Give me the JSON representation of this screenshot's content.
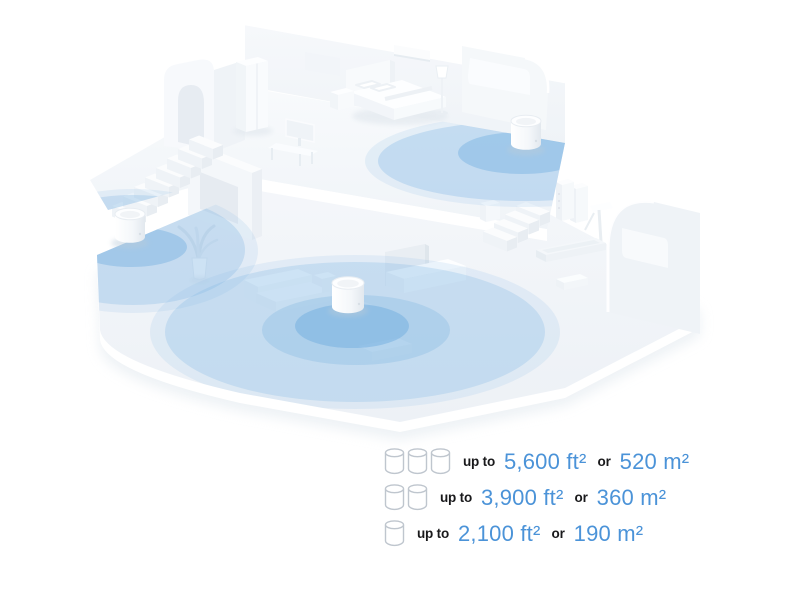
{
  "page": {
    "background": "#ffffff"
  },
  "illustration": {
    "type": "isometric-house-wifi-coverage",
    "device_icon": "mesh-wifi-unit-cylinder",
    "device_count": 3,
    "coverage_color": "#6eafe2",
    "house_color": "#f3f6f9"
  },
  "coverage": {
    "value_color": "#4b93d8",
    "label_color": "#19191b",
    "rows": [
      {
        "units": 3,
        "upto_label": "up to",
        "ft_value": "5,600 ft²",
        "or_label": "or",
        "m_value": "520 m²"
      },
      {
        "units": 2,
        "upto_label": "up to",
        "ft_value": "3,900 ft²",
        "or_label": "or",
        "m_value": "360 m²"
      },
      {
        "units": 1,
        "upto_label": "up to",
        "ft_value": "2,100 ft²",
        "or_label": "or",
        "m_value": "190 m²"
      }
    ]
  }
}
